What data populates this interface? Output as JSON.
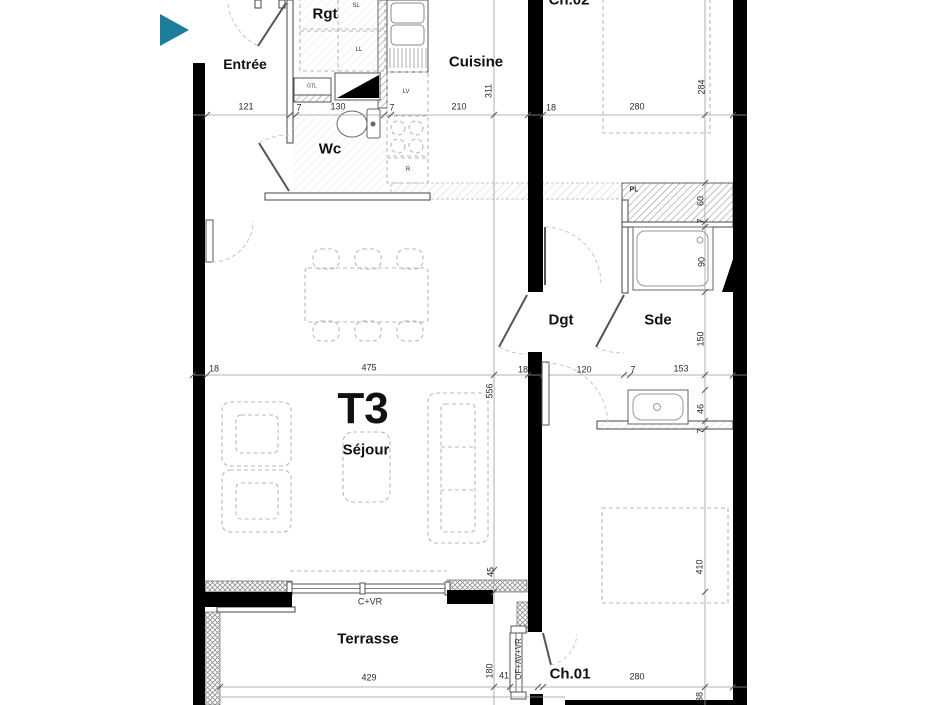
{
  "colors": {
    "marker_accent": "#1d7e9b",
    "wall": "#000000",
    "background": "#ffffff"
  },
  "unit": {
    "label": "T3"
  },
  "rooms": {
    "entree": "Entrée",
    "rgt": "Rgt",
    "cuisine": "Cuisine",
    "wc": "Wc",
    "ch02": "Ch.02",
    "dgt": "Dgt",
    "sde": "Sde",
    "sejour": "Séjour",
    "terrasse": "Terrasse",
    "ch01": "Ch.01"
  },
  "equipment": {
    "gtl": "GTL",
    "sl": "SL",
    "ll": "LL",
    "lv": "LV",
    "fridge": "R",
    "closet": "PL",
    "window_living": "C+VR",
    "window_ch01": "OF+AV+VR"
  },
  "dims": {
    "top": [
      "121",
      "7",
      "130",
      "7",
      "210",
      "18",
      "280"
    ],
    "middle": [
      "18",
      "475",
      "18",
      "120",
      "7",
      "153"
    ],
    "bottom": [
      "429",
      "41",
      "280"
    ],
    "left_chain": [
      "311",
      "556",
      "45",
      "180"
    ],
    "right_chain": [
      "284",
      "60",
      "7",
      "90",
      "150",
      "46",
      "7",
      "410",
      "38"
    ]
  }
}
